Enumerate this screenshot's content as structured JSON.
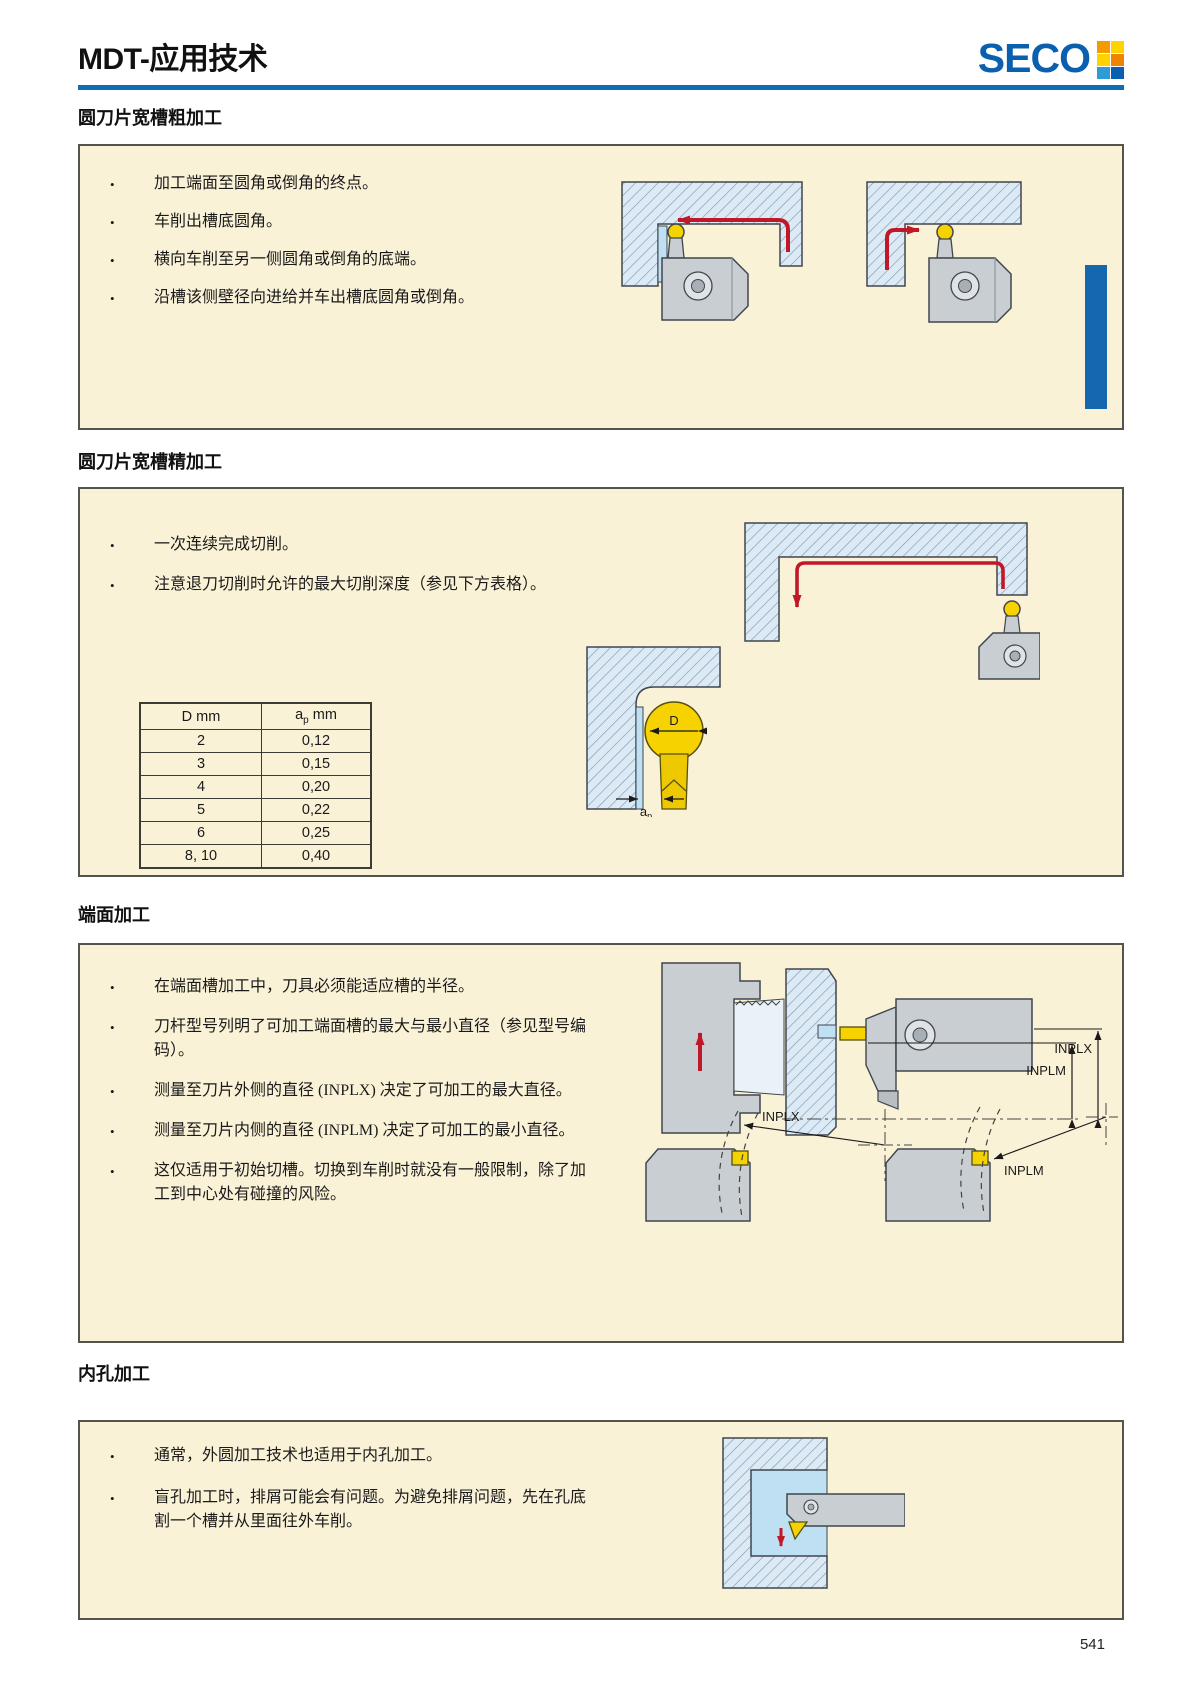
{
  "page": {
    "title": "MDT-应用技术",
    "brand": "SECO",
    "page_number": "541",
    "accent_blue": "#0f6db6",
    "tab_blue": "#1568ae",
    "logo_colors": [
      "#f59b00",
      "#ffd200",
      "#ffd200",
      "#f08300",
      "#2e9bd6",
      "#0a5fae"
    ]
  },
  "sections": [
    {
      "heading": "圆刀片宽槽粗加工",
      "bullets": [
        "加工端面至圆角或倒角的终点。",
        "车削出槽底圆角。",
        "横向车削至另一侧圆角或倒角的底端。",
        "沿槽该侧壁径向进给并车出槽底圆角或倒角。"
      ]
    },
    {
      "heading": "圆刀片宽槽精加工",
      "bullets": [
        "一次连续完成切削。",
        "注意退刀切削时允许的最大切削深度（参见下方表格）。"
      ],
      "table": {
        "col1": "D mm",
        "col2_base": "a",
        "col2_sub": "p",
        "col2_unit": " mm",
        "rows": [
          [
            "2",
            "0,12"
          ],
          [
            "3",
            "0,15"
          ],
          [
            "4",
            "0,20"
          ],
          [
            "5",
            "0,22"
          ],
          [
            "6",
            "0,25"
          ],
          [
            "8, 10",
            "0,40"
          ]
        ]
      },
      "labels": {
        "d": "D",
        "a": "a",
        "p": "p"
      }
    },
    {
      "heading": "端面加工",
      "bullets": [
        "在端面槽加工中，刀具必须能适应槽的半径。",
        "刀杆型号列明了可加工端面槽的最大与最小直径（参见型号编码）。",
        "测量至刀片外侧的直径 (INPLX) 决定了可加工的最大直径。",
        "测量至刀片内侧的直径 (INPLM) 决定了可加工的最小直径。",
        "这仅适用于初始切槽。切换到车削时就没有一般限制，除了加工到中心处有碰撞的风险。"
      ],
      "labels": {
        "inplx": "INPLX",
        "inplm": "INPLM"
      }
    },
    {
      "heading": "内孔加工",
      "bullets": [
        "通常，外圆加工技术也适用于内孔加工。",
        "盲孔加工时，排屑可能会有问题。为避免排屑问题，先在孔底割一个槽并从里面往外车削。"
      ]
    }
  ]
}
